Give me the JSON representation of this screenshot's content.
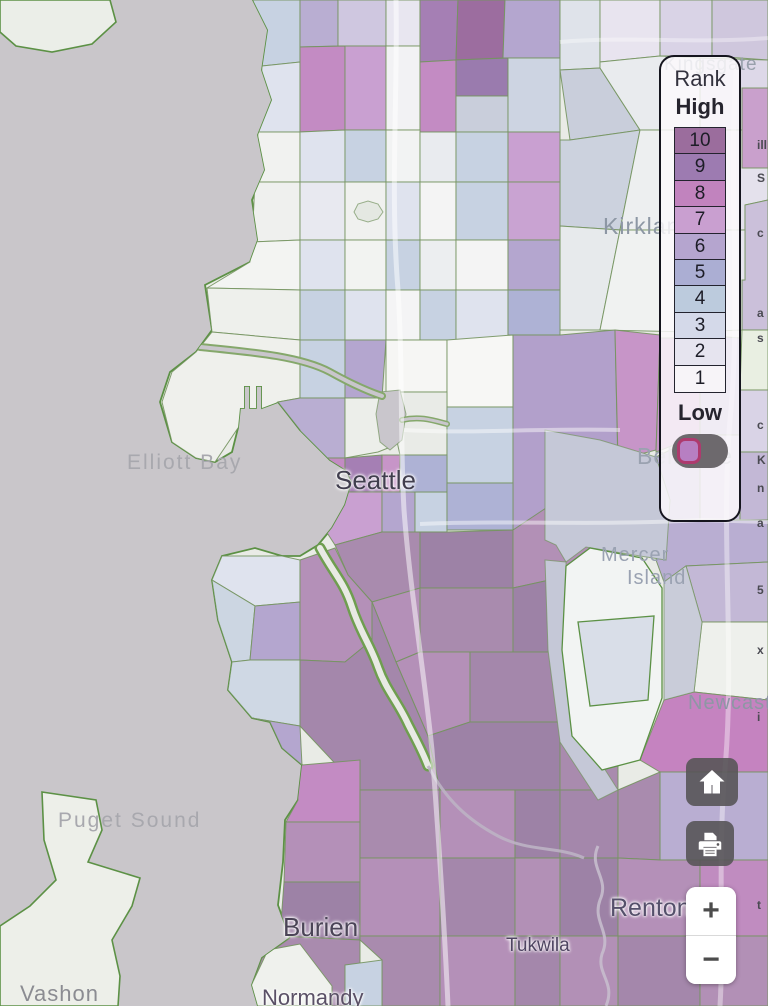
{
  "legend": {
    "title": "Rank",
    "high_label": "High",
    "low_label": "Low",
    "ranks": [
      {
        "value": "10",
        "color": "#9b6d9d"
      },
      {
        "value": "9",
        "color": "#9d7bb1"
      },
      {
        "value": "8",
        "color": "#c183be"
      },
      {
        "value": "7",
        "color": "#c99fd0"
      },
      {
        "value": "6",
        "color": "#b5a5cf"
      },
      {
        "value": "5",
        "color": "#abaed3"
      },
      {
        "value": "4",
        "color": "#bccbdd"
      },
      {
        "value": "3",
        "color": "#d4d9e9"
      },
      {
        "value": "2",
        "color": "#e6e4ef"
      },
      {
        "value": "1",
        "color": "#f7f4f8"
      }
    ],
    "toggle_state": "off"
  },
  "controls": {
    "home_icon": "home",
    "print_icon": "printer",
    "zoom_in_label": "+",
    "zoom_out_label": "−"
  },
  "map": {
    "water_color": "#c9c6ca",
    "land_color": "#e9ebe6",
    "coast_color": "#5c9145",
    "tract_stroke": "#74935f",
    "labels": [
      {
        "text": "Kingsgate",
        "x": 664,
        "y": 55,
        "size": 19,
        "color": "#98a0ab",
        "spacing": 1,
        "halo": false,
        "name": "map-label-kingsgate"
      },
      {
        "text": "Kirkland",
        "x": 603,
        "y": 214,
        "size": 23,
        "color": "#8d97a4",
        "spacing": 1,
        "halo": false,
        "name": "map-label-kirkland"
      },
      {
        "text": "Elliott Bay",
        "x": 127,
        "y": 452,
        "size": 21,
        "color": "#a8a8ae",
        "spacing": 2,
        "halo": false,
        "name": "map-label-elliott-bay"
      },
      {
        "text": "Seattle",
        "x": 335,
        "y": 467,
        "size": 26,
        "color": "#413e4e",
        "spacing": 0,
        "halo": true,
        "name": "map-label-seattle"
      },
      {
        "text": "Bellevue",
        "x": 637,
        "y": 444,
        "size": 23,
        "color": "#9aa2b0",
        "spacing": 1,
        "halo": false,
        "name": "map-label-bellevue"
      },
      {
        "text": "Mercer",
        "x": 601,
        "y": 545,
        "size": 20,
        "color": "#9aa2b2",
        "spacing": 1,
        "halo": false,
        "name": "map-label-mercer"
      },
      {
        "text": "Island",
        "x": 627,
        "y": 568,
        "size": 20,
        "color": "#9aa2b2",
        "spacing": 1,
        "halo": false,
        "name": "map-label-island"
      },
      {
        "text": "Newcastle",
        "x": 688,
        "y": 693,
        "size": 20,
        "color": "#8d97a4",
        "spacing": 1,
        "halo": false,
        "name": "map-label-newcastle"
      },
      {
        "text": "Puget Sound",
        "x": 58,
        "y": 810,
        "size": 21,
        "color": "#a8a8ae",
        "spacing": 2,
        "halo": false,
        "name": "map-label-puget-sound"
      },
      {
        "text": "Renton",
        "x": 610,
        "y": 895,
        "size": 25,
        "color": "#55506b",
        "spacing": 0,
        "halo": true,
        "name": "map-label-renton"
      },
      {
        "text": "Burien",
        "x": 283,
        "y": 914,
        "size": 26,
        "color": "#4b4457",
        "spacing": 0,
        "halo": true,
        "name": "map-label-burien"
      },
      {
        "text": "Tukwila",
        "x": 506,
        "y": 936,
        "size": 19,
        "color": "#4f4562",
        "spacing": 0,
        "halo": true,
        "name": "map-label-tukwila"
      },
      {
        "text": "Vashon",
        "x": 20,
        "y": 982,
        "size": 22,
        "color": "#8b8c92",
        "spacing": 1,
        "halo": false,
        "name": "map-label-vashon"
      },
      {
        "text": "Normandy",
        "x": 262,
        "y": 986,
        "size": 22,
        "color": "#5a5066",
        "spacing": 0,
        "halo": true,
        "name": "map-label-normandy"
      }
    ],
    "edge_fragments": [
      {
        "y": 138,
        "t": "ill"
      },
      {
        "y": 171,
        "t": "S"
      },
      {
        "y": 226,
        "t": "c"
      },
      {
        "y": 306,
        "t": "a"
      },
      {
        "y": 331,
        "t": "s"
      },
      {
        "y": 418,
        "t": "c"
      },
      {
        "y": 453,
        "t": "K"
      },
      {
        "y": 481,
        "t": "n"
      },
      {
        "y": 516,
        "t": "a"
      },
      {
        "y": 583,
        "t": "5"
      },
      {
        "y": 643,
        "t": "x"
      },
      {
        "y": 710,
        "t": "i"
      },
      {
        "y": 898,
        "t": "t"
      }
    ],
    "land": "253,0 268,30 262,70 272,100 258,135 265,170 252,200 258,240 250,262 205,285 212,330 196,352 170,372 160,402 172,442 196,458 215,462 232,452 238,428 240,408 244,408 244,386 250,386 250,408 256,408 256,386 262,386 262,408 270,405 278,402 300,430 330,460 346,470 352,482 345,505 332,528 318,545 300,556 282,556 255,548 222,556 212,580 218,620 232,662 228,690 252,718 270,722 282,748 302,765 298,800 285,820 283,862 278,905 290,938 262,958 252,985 258,1006 768,1006 768,0",
    "islands": [
      {
        "p": "0,0 110,0 116,22 92,44 52,52 16,46 0,32",
        "c": "#ebeee8"
      },
      {
        "p": "42,792 96,800 102,830 88,862 140,878 132,906 112,940 120,976 118,1006 0,1006 0,926 30,906 56,880 44,840",
        "c": "#edefe9"
      }
    ],
    "tracts": [
      {
        "p": "253,0 300,0 300,62 262,66",
        "c": "#c7d2e2"
      },
      {
        "p": "262,66 300,62 300,132 258,132",
        "c": "#dfe3ee"
      },
      {
        "p": "300,0 338,0 338,46 300,47",
        "c": "#b9aed2"
      },
      {
        "p": "338,0 386,0 386,46 338,46",
        "c": "#cfc7e0"
      },
      {
        "p": "386,0 420,0 420,46 386,46",
        "c": "#e8e6f0"
      },
      {
        "p": "300,47 345,46 345,130 300,132",
        "c": "#c38bc3"
      },
      {
        "p": "345,46 386,46 386,130 345,130",
        "c": "#c9a0d1"
      },
      {
        "p": "386,46 420,46 420,130 386,130",
        "c": "#f2f2f4"
      },
      {
        "p": "420,0 458,0 456,60 420,62",
        "c": "#a57fb4"
      },
      {
        "p": "458,0 505,0 503,58 456,60",
        "c": "#9c6d9f"
      },
      {
        "p": "505,0 560,0 560,58 503,58",
        "c": "#b4a6cf"
      },
      {
        "p": "420,62 456,60 456,132 420,132",
        "c": "#c38bc3"
      },
      {
        "p": "456,60 508,58 508,96 456,96",
        "c": "#9a7bae"
      },
      {
        "p": "456,96 508,96 508,132 456,132",
        "c": "#c9cedb"
      },
      {
        "p": "508,58 560,58 560,132 508,132",
        "c": "#cdd4e2"
      },
      {
        "p": "560,0 600,0 600,68 560,70",
        "c": "#dfe3ea"
      },
      {
        "p": "600,0 660,0 660,56 600,62",
        "c": "#e8e4ef"
      },
      {
        "p": "660,0 712,0 712,56 660,56",
        "c": "#d9d3e6"
      },
      {
        "p": "712,0 768,0 768,60 712,56",
        "c": "#cfc7dd"
      },
      {
        "p": "560,70 600,68 640,130 570,140",
        "c": "#c9cedb"
      },
      {
        "p": "560,140 570,140 640,130 620,230 560,226",
        "c": "#ccd2de"
      },
      {
        "p": "600,62 660,56 700,58 700,130 640,130 600,68",
        "c": "#e9ebee"
      },
      {
        "p": "700,58 768,60 768,130 700,130",
        "c": "#ddd8e8"
      },
      {
        "p": "640,130 700,130 700,230 620,230",
        "c": "#edeff0"
      },
      {
        "p": "700,130 768,130 768,200 745,205 745,230 700,230",
        "c": "#e4e1ec"
      },
      {
        "p": "742,88 768,88 768,168 742,168",
        "c": "#c9a0cc"
      },
      {
        "p": "745,205 768,200 768,330 742,330 742,280 745,280",
        "c": "#cbc0da"
      },
      {
        "p": "560,226 620,230 600,330 560,330",
        "c": "#e7eaec"
      },
      {
        "p": "620,230 700,230 692,332 600,330",
        "c": "#f0f2f1"
      },
      {
        "p": "700,230 745,230 745,280 742,280 742,330 692,332",
        "c": "#e7e5ee"
      },
      {
        "p": "742,330 768,330 768,390 740,390",
        "c": "#e9efe2"
      },
      {
        "p": "258,132 300,132 300,182 255,182",
        "c": "#f1f2f0"
      },
      {
        "p": "255,182 300,182 300,240 252,242",
        "c": "#eff0ee"
      },
      {
        "p": "252,242 300,240 300,290 207,288 250,262",
        "c": "#f3f4f2"
      },
      {
        "p": "207,288 300,290 300,340 212,332",
        "c": "#eef0ec"
      },
      {
        "p": "300,132 345,130 345,182 300,182",
        "c": "#dfe3ee"
      },
      {
        "p": "345,130 386,130 386,182 345,182",
        "c": "#c7d2e2"
      },
      {
        "p": "386,130 420,130 420,182 386,182",
        "c": "#f2f3f3"
      },
      {
        "p": "420,132 456,132 456,182 420,182",
        "c": "#e9ebef"
      },
      {
        "p": "456,132 508,132 508,182 456,182",
        "c": "#c7d2e2"
      },
      {
        "p": "508,132 560,132 560,182 508,182",
        "c": "#c9a0d1"
      },
      {
        "p": "300,182 345,182 345,240 300,240",
        "c": "#e8e9f0"
      },
      {
        "p": "345,182 386,182 386,240 345,240",
        "c": "#f0f1ef"
      },
      {
        "p": "386,182 420,182 420,240 386,240",
        "c": "#dfe3ee"
      },
      {
        "p": "420,182 456,182 456,240 420,240",
        "c": "#f4f4f4"
      },
      {
        "p": "456,182 508,182 508,240 456,240",
        "c": "#c7d2e2"
      },
      {
        "p": "508,182 560,182 560,240 508,240",
        "c": "#c9a3d2"
      },
      {
        "p": "300,240 345,240 345,290 300,290",
        "c": "#dfe3ee"
      },
      {
        "p": "345,240 386,240 386,290 345,290",
        "c": "#f2f3f1"
      },
      {
        "p": "386,240 420,240 420,290 386,290",
        "c": "#c7d2e2"
      },
      {
        "p": "420,240 456,240 456,290 420,290",
        "c": "#eceef0"
      },
      {
        "p": "456,240 508,240 508,290 456,290",
        "c": "#f4f4f4"
      },
      {
        "p": "508,240 560,240 560,290 508,290",
        "c": "#b4a6cf"
      },
      {
        "p": "300,290 345,290 345,340 300,340",
        "c": "#c7d2e2"
      },
      {
        "p": "345,290 386,290 386,340 345,340",
        "c": "#dfe3ee"
      },
      {
        "p": "386,290 420,290 420,340 386,340",
        "c": "#f4f4f5"
      },
      {
        "p": "420,290 456,290 456,340 420,340",
        "c": "#c7d2e2"
      },
      {
        "p": "456,290 508,290 508,340 456,340",
        "c": "#dfe3ee"
      },
      {
        "p": "508,290 560,290 560,335 508,335",
        "c": "#aeb2d5"
      },
      {
        "p": "212,332 300,340 300,398 278,402 238,428 215,462 196,458 172,442 162,402 172,372 196,352",
        "c": "#eff0ec"
      },
      {
        "p": "300,340 345,340 345,398 300,398",
        "c": "#c7d2e2"
      },
      {
        "p": "345,340 386,340 382,398 345,398",
        "c": "#b4a6cf"
      },
      {
        "p": "278,402 300,398 345,398 345,458 312,458 300,430",
        "c": "#b9aed2"
      },
      {
        "p": "345,398 382,398 388,448 378,452 345,458",
        "c": "#eceeea"
      },
      {
        "p": "386,340 447,340 447,392 386,392",
        "c": "#f6f6f4"
      },
      {
        "p": "447,340 513,335 513,407 447,407",
        "c": "#f7f7f5"
      },
      {
        "p": "386,392 447,392 447,455 400,455",
        "c": "#e9ebe7"
      },
      {
        "p": "447,407 513,407 513,483 447,483",
        "c": "#c7d2e2"
      },
      {
        "p": "513,335 560,335 615,330 618,470 560,530 513,530",
        "c": "#b2a0cb"
      },
      {
        "p": "615,330 660,335 656,450 618,460",
        "c": "#c795c8"
      },
      {
        "p": "660,338 700,338 700,435 656,452",
        "c": "#c795c8"
      },
      {
        "p": "312,458 345,458 345,492 322,525",
        "c": "#c38bc3"
      },
      {
        "p": "345,458 382,455 382,492 345,492",
        "c": "#a57fb4"
      },
      {
        "p": "382,455 400,455 400,492 382,492",
        "c": "#c795c8"
      },
      {
        "p": "322,525 345,492 382,492 382,532 335,545",
        "c": "#c9a0d1"
      },
      {
        "p": "382,492 415,492 415,532 382,532",
        "c": "#b4a6cf"
      },
      {
        "p": "415,492 447,492 447,532 415,532",
        "c": "#c7d2e2"
      },
      {
        "p": "400,455 447,455 447,492 400,492",
        "c": "#aeb2d5"
      },
      {
        "p": "447,483 513,483 513,530 447,530",
        "c": "#aeb2d5"
      },
      {
        "p": "335,545 382,532 420,532 420,588 372,602 348,575",
        "c": "#a98bae"
      },
      {
        "p": "420,532 447,532 513,530 513,588 420,588",
        "c": "#9d82a6"
      },
      {
        "p": "513,530 618,460 618,565 513,588",
        "c": "#b290b6"
      },
      {
        "p": "372,602 420,588 420,652 396,662",
        "c": "#b490b8"
      },
      {
        "p": "420,588 513,588 513,652 420,652",
        "c": "#a98bae"
      },
      {
        "p": "513,588 618,565 618,652 513,652",
        "c": "#9d82a6"
      },
      {
        "p": "396,662 420,652 470,652 470,722 428,736",
        "c": "#b490b8"
      },
      {
        "p": "470,652 560,652 560,722 470,722",
        "c": "#a487ab"
      },
      {
        "p": "560,652 618,652 618,732 560,722",
        "c": "#b290b6"
      },
      {
        "p": "428,736 470,722 560,722 560,790 440,790",
        "c": "#9d82a6"
      },
      {
        "p": "560,722 618,732 618,790 560,790",
        "c": "#a98bae"
      },
      {
        "p": "222,556 282,556 300,560 300,602 255,606 212,580",
        "c": "#dfe3ee"
      },
      {
        "p": "212,580 255,606 250,660 232,662 218,620",
        "c": "#ccd6e2"
      },
      {
        "p": "255,606 300,602 300,660 250,660",
        "c": "#b4a6cf"
      },
      {
        "p": "232,662 250,660 300,660 300,726 252,718 228,690",
        "c": "#cfd8e4"
      },
      {
        "p": "300,560 335,548 348,575 372,602 372,640 345,662 300,660 300,602",
        "c": "#b490b8"
      },
      {
        "p": "252,718 300,726 302,765 282,748 270,722",
        "c": "#b4a6cf"
      },
      {
        "p": "300,660 345,662 372,640 372,602 396,662 428,736 440,790 360,790 300,726",
        "c": "#a487ab"
      },
      {
        "p": "298,765 302,765 360,760 360,822 286,822 298,800",
        "c": "#c38bc3"
      },
      {
        "p": "286,822 360,822 360,882 284,882",
        "c": "#b490b8"
      },
      {
        "p": "284,882 360,882 360,940 280,936",
        "c": "#9d82a6"
      },
      {
        "p": "280,936 360,940 360,1006 258,1006 252,985 262,958 290,938",
        "c": "#a98bae"
      },
      {
        "p": "250,988 268,950 300,944 332,986 332,1006 254,1006",
        "c": "#eff1ed"
      },
      {
        "p": "360,790 440,790 440,858 360,858",
        "c": "#a98bae"
      },
      {
        "p": "440,790 515,790 515,858 440,858",
        "c": "#b490b8"
      },
      {
        "p": "515,790 560,790 560,858 515,858",
        "c": "#9d82a6"
      },
      {
        "p": "560,790 618,790 618,858 560,858",
        "c": "#a487ab"
      },
      {
        "p": "360,858 440,858 440,936 360,936",
        "c": "#b490b8"
      },
      {
        "p": "440,858 515,858 515,936 440,936",
        "c": "#a487ab"
      },
      {
        "p": "515,858 560,858 560,936 515,936",
        "c": "#b290b6"
      },
      {
        "p": "560,858 618,858 618,936 560,936",
        "c": "#9d82a6"
      },
      {
        "p": "360,936 440,936 440,1006 382,1006 382,960 360,940",
        "c": "#a98bae"
      },
      {
        "p": "345,965 382,960 382,1006 345,1006",
        "c": "#c7d2e2"
      },
      {
        "p": "440,936 515,936 515,1006 440,1006",
        "c": "#b490b8"
      },
      {
        "p": "515,936 560,936 560,1006 515,1006",
        "c": "#a487ab"
      },
      {
        "p": "560,936 618,936 618,1006 560,1006",
        "c": "#b290b6"
      },
      {
        "p": "656,457 700,435 700,520 668,520 670,500",
        "c": "#b9aed2"
      },
      {
        "p": "700,335 740,338 740,435 700,435",
        "c": "#b4a6cf"
      },
      {
        "p": "740,390 768,390 768,452 740,452",
        "c": "#d9d3e6"
      },
      {
        "p": "700,435 740,435 740,520 700,520",
        "c": "#cbc3dd"
      },
      {
        "p": "740,452 768,452 768,520 740,520",
        "c": "#c3b8d6"
      },
      {
        "p": "668,520 768,520 768,562 686,566 664,582 656,560",
        "c": "#b9aed2"
      },
      {
        "p": "686,566 768,562 768,622 702,622",
        "c": "#c3b8d6"
      },
      {
        "p": "702,622 768,622 768,700 694,692",
        "c": "#eef0ec"
      },
      {
        "p": "664,700 694,692 768,700 768,772 660,772 640,760",
        "c": "#c583c0"
      },
      {
        "p": "660,772 768,772 768,860 660,860",
        "c": "#b9aed2"
      },
      {
        "p": "618,790 660,772 660,860 618,858",
        "c": "#a98bae"
      },
      {
        "p": "618,858 660,860 700,860 700,936 618,936",
        "c": "#b490b8"
      },
      {
        "p": "700,860 768,860 768,936 700,936",
        "c": "#c08cc0"
      },
      {
        "p": "618,936 700,936 700,1006 618,1006",
        "c": "#a487ab"
      },
      {
        "p": "700,936 768,936 768,1006 700,1006",
        "c": "#b290b6"
      }
    ],
    "lakes": [
      {
        "p": "545,430 600,440 656,457 670,500 666,560 640,556 586,547 566,562 556,545 545,540",
        "c": "#c5c8d7"
      },
      {
        "p": "545,560 566,562 566,650 576,735 604,768 618,790 598,800 560,742 548,650",
        "c": "#c5c8d7"
      },
      {
        "p": "664,582 686,566 702,622 694,692 664,700",
        "c": "#c9ccd9"
      },
      {
        "p": "380,392 400,390 406,414 402,440 390,450 380,442 376,414",
        "c": "#c9c6cc"
      },
      {
        "p": "354,212 358,204 368,201 378,204 383,212 378,219 368,222 358,219",
        "c": "#e4e8e2"
      }
    ],
    "special_tracts": [
      {
        "p": "566,566 590,548 642,558 662,588 662,698 640,760 602,770 572,736 562,650",
        "c": "#f2f4f3"
      },
      {
        "p": "578,622 654,616 648,700 590,706",
        "c": "#d9dee8"
      }
    ],
    "rivers": [
      {
        "d": "M320,548 C334,574 344,582 352,607 C360,632 370,644 378,667 C386,690 398,702 408,724 C414,736 422,750 428,766",
        "ow": 11,
        "iw": 6,
        "oc": "#6f9e50",
        "ic": "#e8eae4"
      },
      {
        "d": "M200,347 C250,352 300,356 330,372 C348,382 364,390 382,396",
        "ow": 8,
        "iw": 4,
        "oc": "#85a86b",
        "ic": "#c9c6cc"
      },
      {
        "d": "M402,420 C420,416 432,420 447,424",
        "ow": 6,
        "iw": 3,
        "oc": "#85a86b",
        "ic": "#c9c6cc"
      }
    ],
    "streams": [
      {
        "d": "M428,766 C446,800 468,820 498,836 C528,852 558,846 584,858",
        "w": 3,
        "c": "#bdb2c4"
      },
      {
        "d": "M598,846 C588,868 610,878 600,900 C592,922 612,932 602,954 C596,974 616,982 606,1006",
        "w": 3,
        "c": "#c6bccd"
      }
    ],
    "roads": [
      {
        "d": "M396,0 C398,90 390,190 398,290 C403,370 400,440 404,510 C410,590 424,670 432,750 C438,830 444,915 448,1006",
        "w": 5,
        "o": 0.5
      },
      {
        "d": "M404,430 C470,434 540,428 620,430",
        "w": 4,
        "o": 0.45
      },
      {
        "d": "M420,524 C500,520 600,526 700,520 L768,522",
        "w": 4,
        "o": 0.45
      },
      {
        "d": "M737,60 C727,180 742,300 730,420 C720,540 736,660 724,780 C718,870 724,940 720,1006",
        "w": 5,
        "o": 0.4
      },
      {
        "d": "M560,42 C630,36 700,44 768,38",
        "w": 4,
        "o": 0.35
      }
    ]
  }
}
